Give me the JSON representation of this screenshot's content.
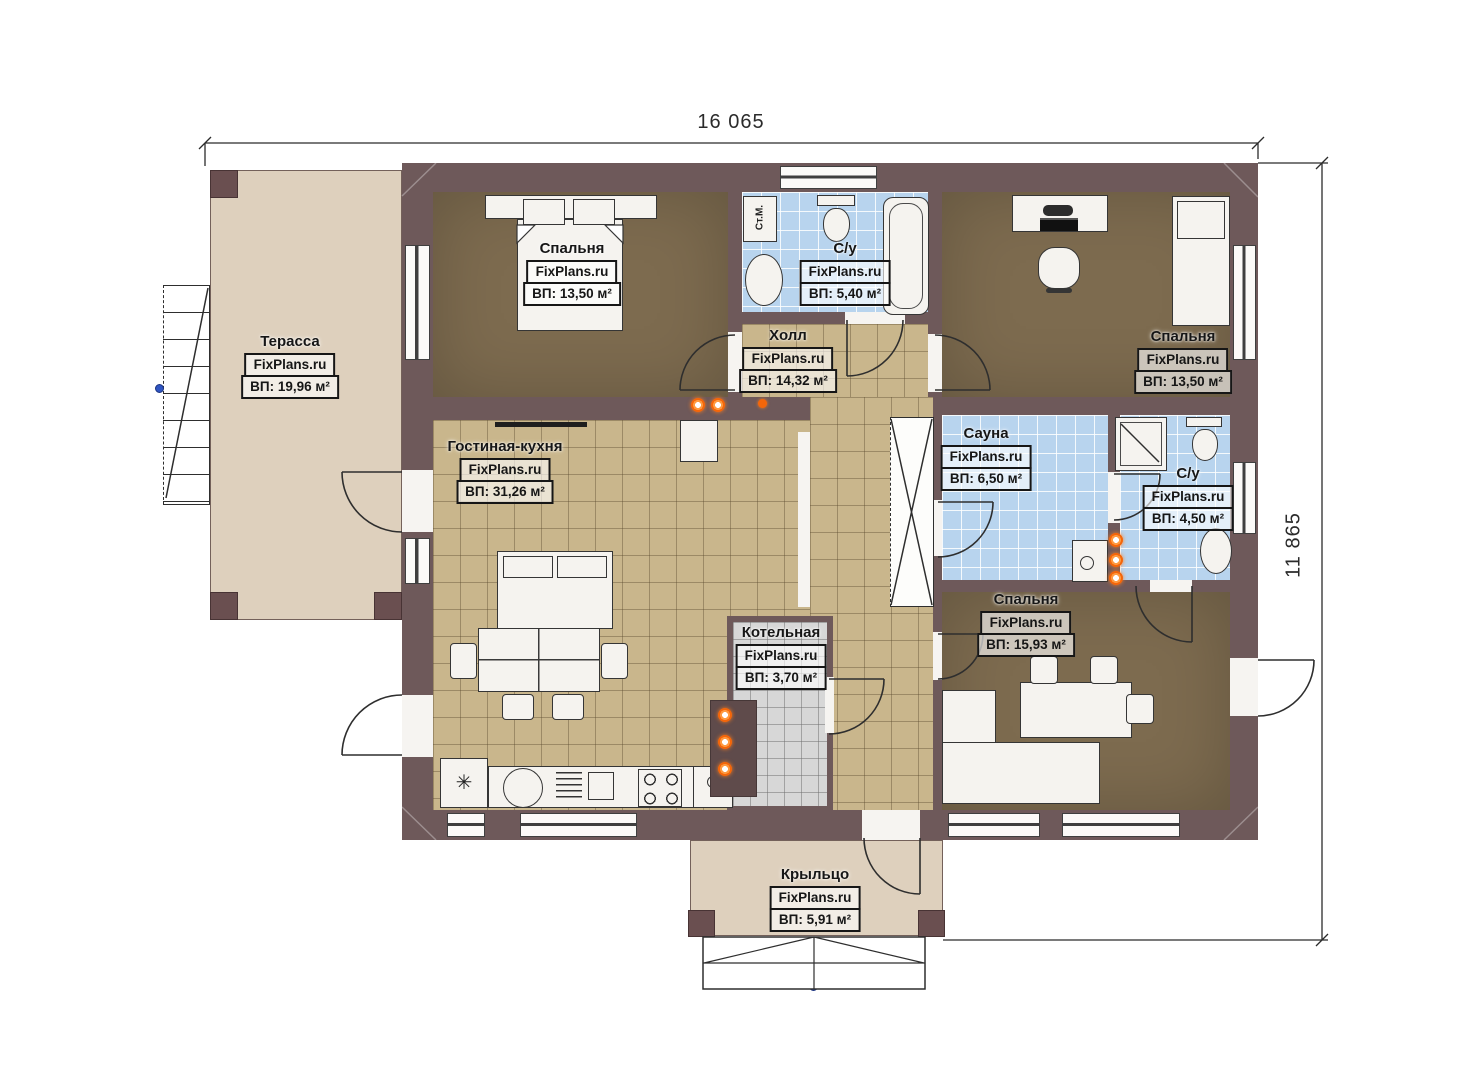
{
  "dimensions": {
    "width_label": "16 065",
    "height_label": "11 865"
  },
  "watermark": "FixPlans.ru",
  "rooms": {
    "terrace": {
      "name": "Терасса",
      "area": "ВП: 19,96 м²"
    },
    "bedroom1": {
      "name": "Спальня",
      "area": "ВП: 13,50 м²"
    },
    "bath1": {
      "name": "С/у",
      "area": "ВП: 5,40 м²"
    },
    "hall": {
      "name": "Холл",
      "area": "ВП: 14,32 м²"
    },
    "bedroom2": {
      "name": "Спальня",
      "area": "ВП: 13,50 м²"
    },
    "living": {
      "name": "Гостиная-кухня",
      "area": "ВП: 31,26 м²"
    },
    "sauna": {
      "name": "Сауна",
      "area": "ВП: 6,50 м²"
    },
    "bath2": {
      "name": "С/у",
      "area": "ВП: 4,50 м²"
    },
    "boiler": {
      "name": "Котельная",
      "area": "ВП: 3,70 м²"
    },
    "bedroom3": {
      "name": "Спальня",
      "area": "ВП: 15,93 м²"
    },
    "porch": {
      "name": "Крыльцо",
      "area": "ВП: 5,91 м²"
    }
  },
  "labels": {
    "washing_machine": "Ст.М.",
    "fridge_symbol": "✳"
  },
  "colors": {
    "wall": "#6e595a",
    "wood_floor": "#7d6b4f",
    "tile_floor": "#c9b68c",
    "bath_tile": "#b8d4ee",
    "boiler_floor": "#d7d7d7",
    "outdoor": "#ded0bd",
    "flame": "#f4660a",
    "marker_blue": "#2f55c2"
  }
}
